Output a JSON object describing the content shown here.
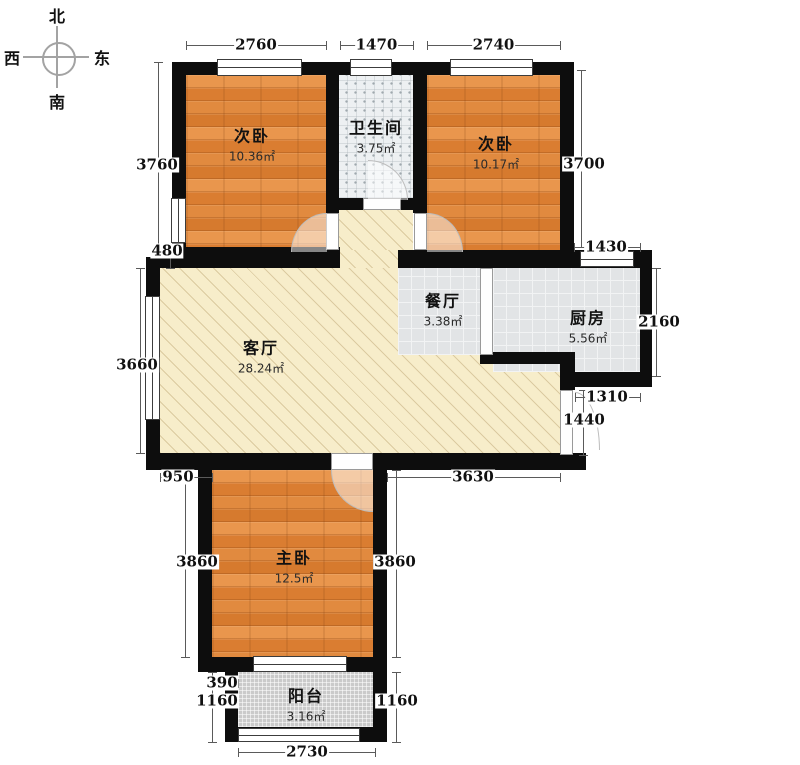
{
  "compass": {
    "north": "北",
    "south": "南",
    "west": "西",
    "east": "东"
  },
  "rooms": {
    "bedroom_left": {
      "name": "次卧",
      "area": "10.36㎡"
    },
    "bathroom": {
      "name": "卫生间",
      "area": "3.75㎡"
    },
    "bedroom_right": {
      "name": "次卧",
      "area": "10.17㎡"
    },
    "dining": {
      "name": "餐厅",
      "area": "3.38㎡"
    },
    "kitchen": {
      "name": "厨房",
      "area": "5.56㎡"
    },
    "living": {
      "name": "客厅",
      "area": "28.24㎡"
    },
    "master": {
      "name": "主卧",
      "area": "12.5㎡"
    },
    "balcony": {
      "name": "阳台",
      "area": "3.16㎡"
    }
  },
  "dimensions": [
    {
      "v": "2760",
      "o": "h",
      "x1": 186,
      "x2": 326,
      "y": 45
    },
    {
      "v": "1470",
      "o": "h",
      "x1": 340,
      "x2": 413,
      "y": 45
    },
    {
      "v": "2740",
      "o": "h",
      "x1": 427,
      "x2": 560,
      "y": 45
    },
    {
      "v": "3760",
      "o": "v",
      "x": 158,
      "y1": 62,
      "y2": 247,
      "lx": 157,
      "ly": 165
    },
    {
      "v": "480",
      "o": "v",
      "x": 170,
      "y1": 247,
      "y2": 268,
      "lx": 167,
      "ly": 251
    },
    {
      "v": "3660",
      "o": "v",
      "x": 140,
      "y1": 268,
      "y2": 453,
      "lx": 137,
      "ly": 365
    },
    {
      "v": "950",
      "o": "h",
      "x1": 160,
      "x2": 212,
      "y": 477,
      "lx": 178
    },
    {
      "v": "3860",
      "o": "v",
      "x": 185,
      "y1": 470,
      "y2": 657,
      "lx": 197,
      "ly": 562
    },
    {
      "v": "3860",
      "o": "v",
      "x": 396,
      "y1": 470,
      "y2": 657,
      "lx": 395,
      "ly": 562
    },
    {
      "v": "3630",
      "o": "h",
      "x1": 387,
      "x2": 560,
      "y": 477,
      "lx": 473
    },
    {
      "v": "390",
      "o": "h",
      "x1": 212,
      "x2": 238,
      "y": 683,
      "lx": 222
    },
    {
      "v": "1160",
      "o": "v",
      "x": 212,
      "y1": 672,
      "y2": 742,
      "lx": 217,
      "ly": 701
    },
    {
      "v": "1160",
      "o": "v",
      "x": 396,
      "y1": 672,
      "y2": 742,
      "lx": 397,
      "ly": 701
    },
    {
      "v": "2730",
      "o": "h",
      "x1": 238,
      "x2": 375,
      "y": 752,
      "lx": 307
    },
    {
      "v": "3700",
      "o": "v",
      "x": 581,
      "y1": 70,
      "y2": 247,
      "lx": 584,
      "ly": 164
    },
    {
      "v": "1430",
      "o": "h",
      "x1": 574,
      "x2": 640,
      "y": 247,
      "lx": 606
    },
    {
      "v": "2160",
      "o": "v",
      "x": 656,
      "y1": 268,
      "y2": 376,
      "lx": 659,
      "ly": 322
    },
    {
      "v": "1310",
      "o": "h",
      "x1": 575,
      "x2": 640,
      "y": 397,
      "lx": 607
    },
    {
      "v": "1440",
      "o": "v",
      "x": 583,
      "y1": 390,
      "y2": 455,
      "lx": 584,
      "ly": 420
    }
  ]
}
